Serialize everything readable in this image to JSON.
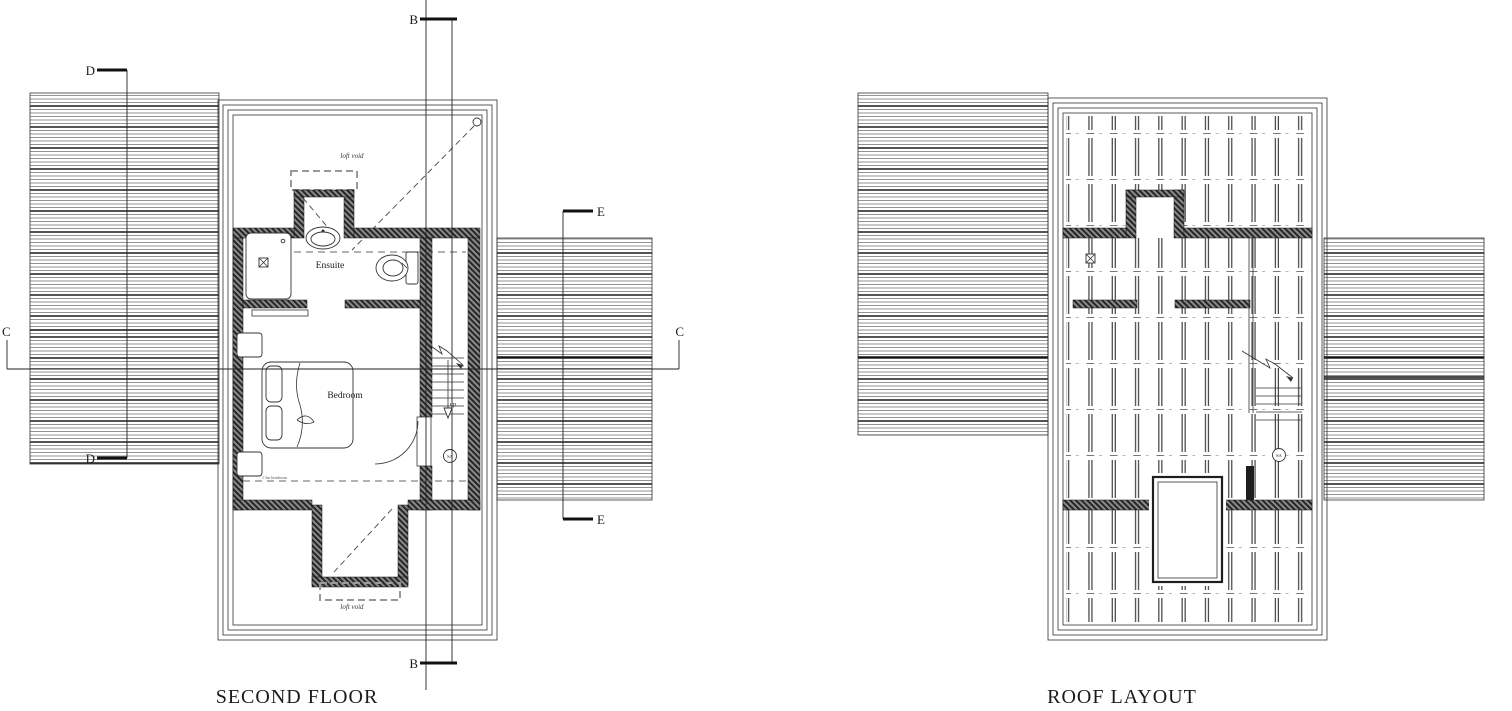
{
  "left_plan": {
    "title": "SECOND FLOOR",
    "labels": {
      "loft_void_top": "loft void",
      "loft_void_bottom": "loft void",
      "ensuite": "Ensuite",
      "bedroom": "Bedroom",
      "up": "up",
      "smoke_alarm": "SA",
      "headroom_line_1": "1.5m headroom",
      "headroom_line_2": "1.5m headroom"
    }
  },
  "right_plan": {
    "title": "ROOF LAYOUT",
    "labels": {
      "smoke_alarm": "SA"
    }
  },
  "section_markers": {
    "b_top": "B",
    "b_bottom": "B",
    "c_left": "C",
    "c_right": "C",
    "d_top": "D",
    "d_bottom": "D",
    "e_top": "E",
    "e_bottom": "E"
  },
  "colors": {
    "line": "#1a1a1a",
    "hatch": "#555555",
    "wall_fill": "#3c3c3c",
    "background": "#ffffff"
  }
}
